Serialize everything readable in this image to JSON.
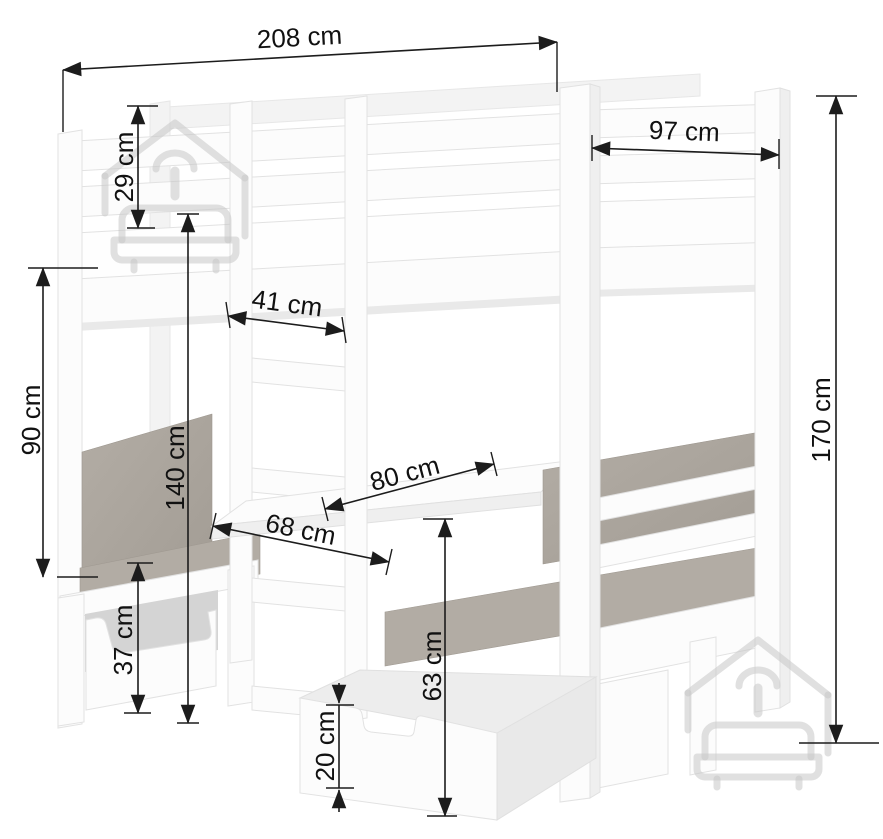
{
  "diagram": {
    "subject": "loft bed with under-bed seating bench set, table and storage drawers",
    "unit": "cm",
    "colors": {
      "background": "#ffffff",
      "furniture": "#fcfcfc",
      "cushion": "#a9a39b",
      "dimension_lines": "#1c1c1c",
      "watermark": "#c6c6c6"
    }
  },
  "dims": [
    {
      "name": "total-length",
      "label": "208 cm",
      "orientation": "horizontal"
    },
    {
      "name": "bed-width",
      "label": "97 cm",
      "orientation": "horizontal"
    },
    {
      "name": "guardrail-height",
      "label": "29 cm",
      "orientation": "vertical"
    },
    {
      "name": "ladder-width",
      "label": "41 cm",
      "orientation": "horizontal"
    },
    {
      "name": "underbed-clearance",
      "label": "90 cm",
      "orientation": "vertical"
    },
    {
      "name": "underbed-height",
      "label": "140 cm",
      "orientation": "vertical"
    },
    {
      "name": "table-length",
      "label": "80 cm",
      "orientation": "diagonal"
    },
    {
      "name": "table-width",
      "label": "68 cm",
      "orientation": "diagonal"
    },
    {
      "name": "bench-height",
      "label": "37 cm",
      "orientation": "vertical"
    },
    {
      "name": "table-top-height",
      "label": "63 cm",
      "orientation": "vertical"
    },
    {
      "name": "drawer-height",
      "label": "20 cm",
      "orientation": "vertical"
    },
    {
      "name": "total-height",
      "label": "170 cm",
      "orientation": "vertical"
    }
  ],
  "watermark": {
    "icon": "house-with-hanger-and-sofa-logo",
    "count": 2
  }
}
